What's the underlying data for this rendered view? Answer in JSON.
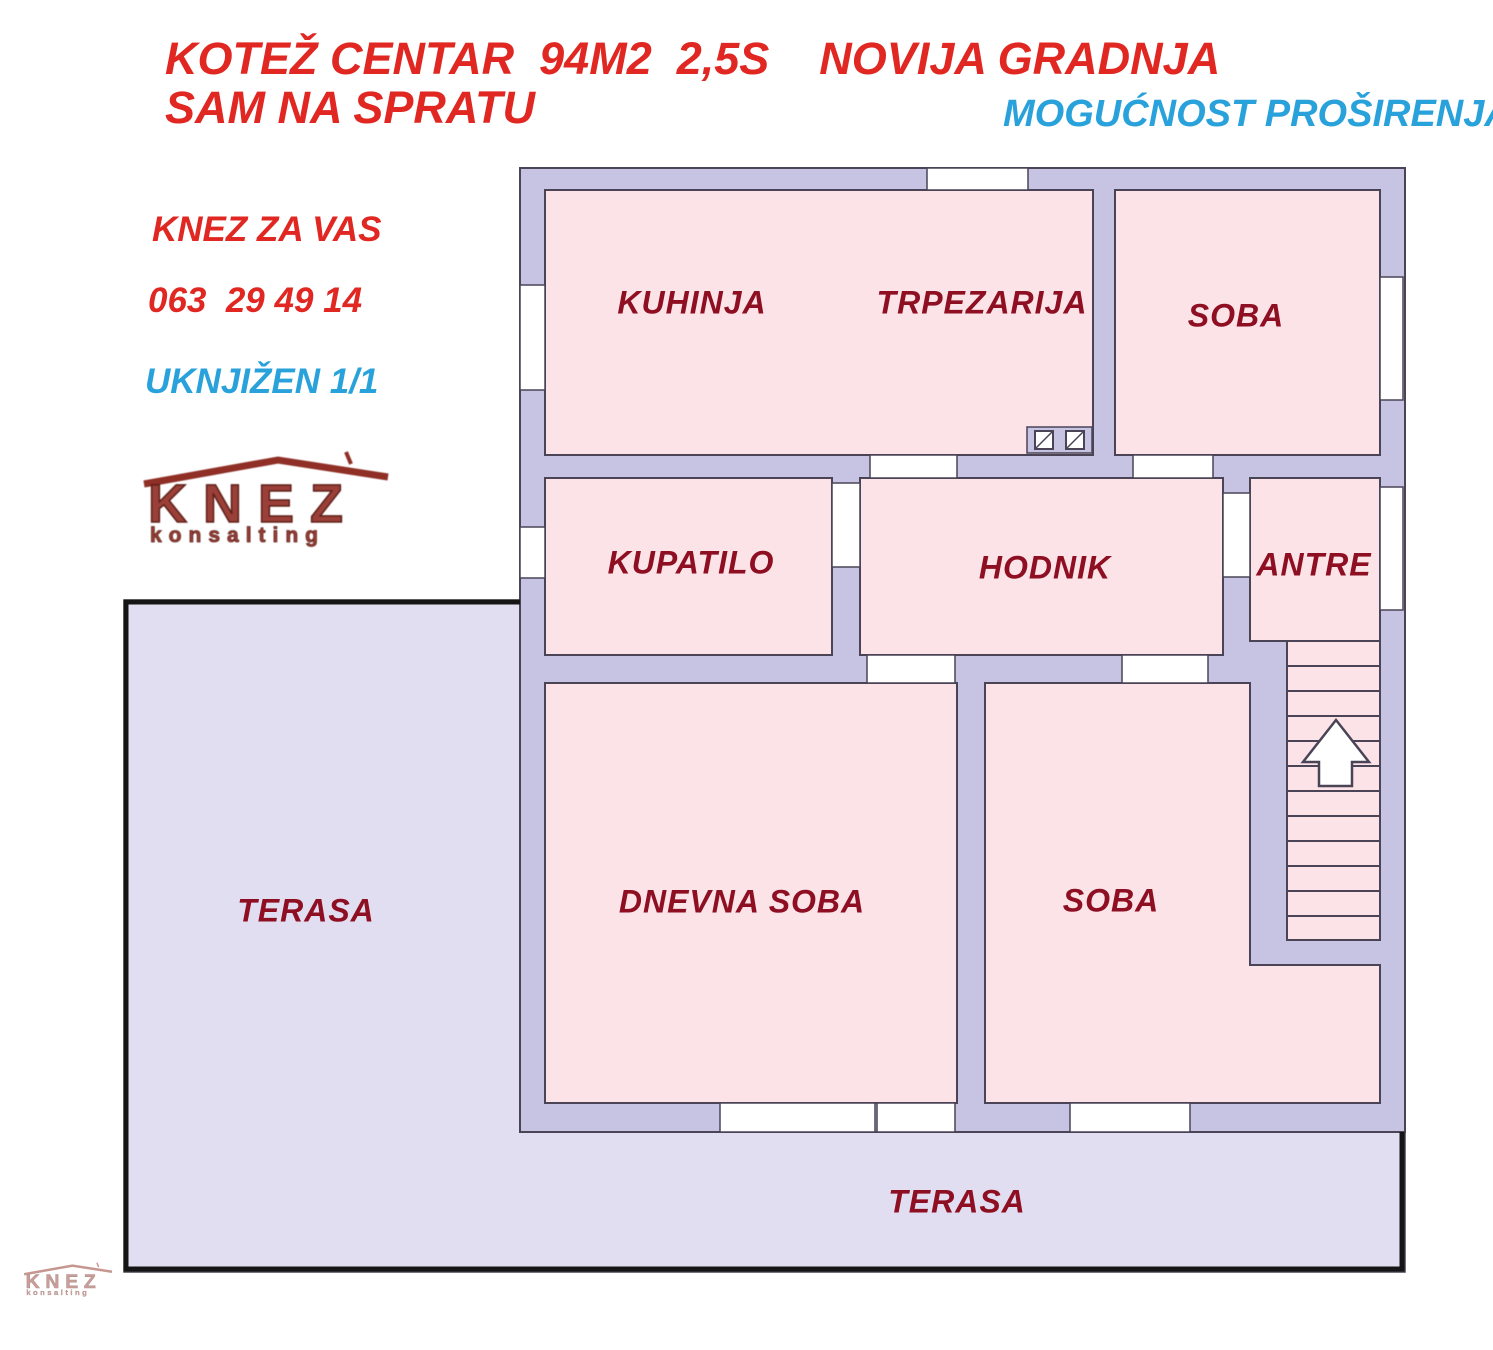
{
  "header": {
    "title_line1": "KOTEŽ CENTAR  94M2  2,5S    NOVIJA GRADNJA",
    "title_line2": "SAM NA SPRATU",
    "expansion_note": "MOGUĆNOST PROŠIRENJA",
    "agency_tagline": "KNEZ ZA VAS",
    "phone": "063  29 49 14",
    "ownership": "UKNJIŽEN 1/1"
  },
  "logo": {
    "name": "KNEZ",
    "subtitle": "konsalting"
  },
  "floor_plan": {
    "rooms": [
      {
        "id": "kuhinja",
        "label": "KUHINJA"
      },
      {
        "id": "trpezarija",
        "label": "TRPEZARIJA"
      },
      {
        "id": "soba-top",
        "label": "SOBA"
      },
      {
        "id": "kupatilo",
        "label": "KUPATILO"
      },
      {
        "id": "hodnik",
        "label": "HODNIK"
      },
      {
        "id": "antre",
        "label": "ANTRE"
      },
      {
        "id": "dnevna-soba",
        "label": "DNEVNA SOBA"
      },
      {
        "id": "soba-bottom",
        "label": "SOBA"
      },
      {
        "id": "terasa-left",
        "label": "TERASA"
      },
      {
        "id": "terasa-bottom",
        "label": "TERASA"
      }
    ],
    "features": [
      "staircase-12-treads",
      "stairs-up-arrow",
      "two-vent-shafts",
      "entrance-door-right-wall"
    ],
    "colors": {
      "wall": "#c7c3e3",
      "room_fill": "#fbe3e8",
      "terrace_fill": "#e2def1",
      "outline": "#4a4456",
      "terrace_border": "#151515",
      "label_red": "#8e0e22",
      "title_red": "#e02722",
      "accent_blue": "#29a2dc"
    }
  }
}
